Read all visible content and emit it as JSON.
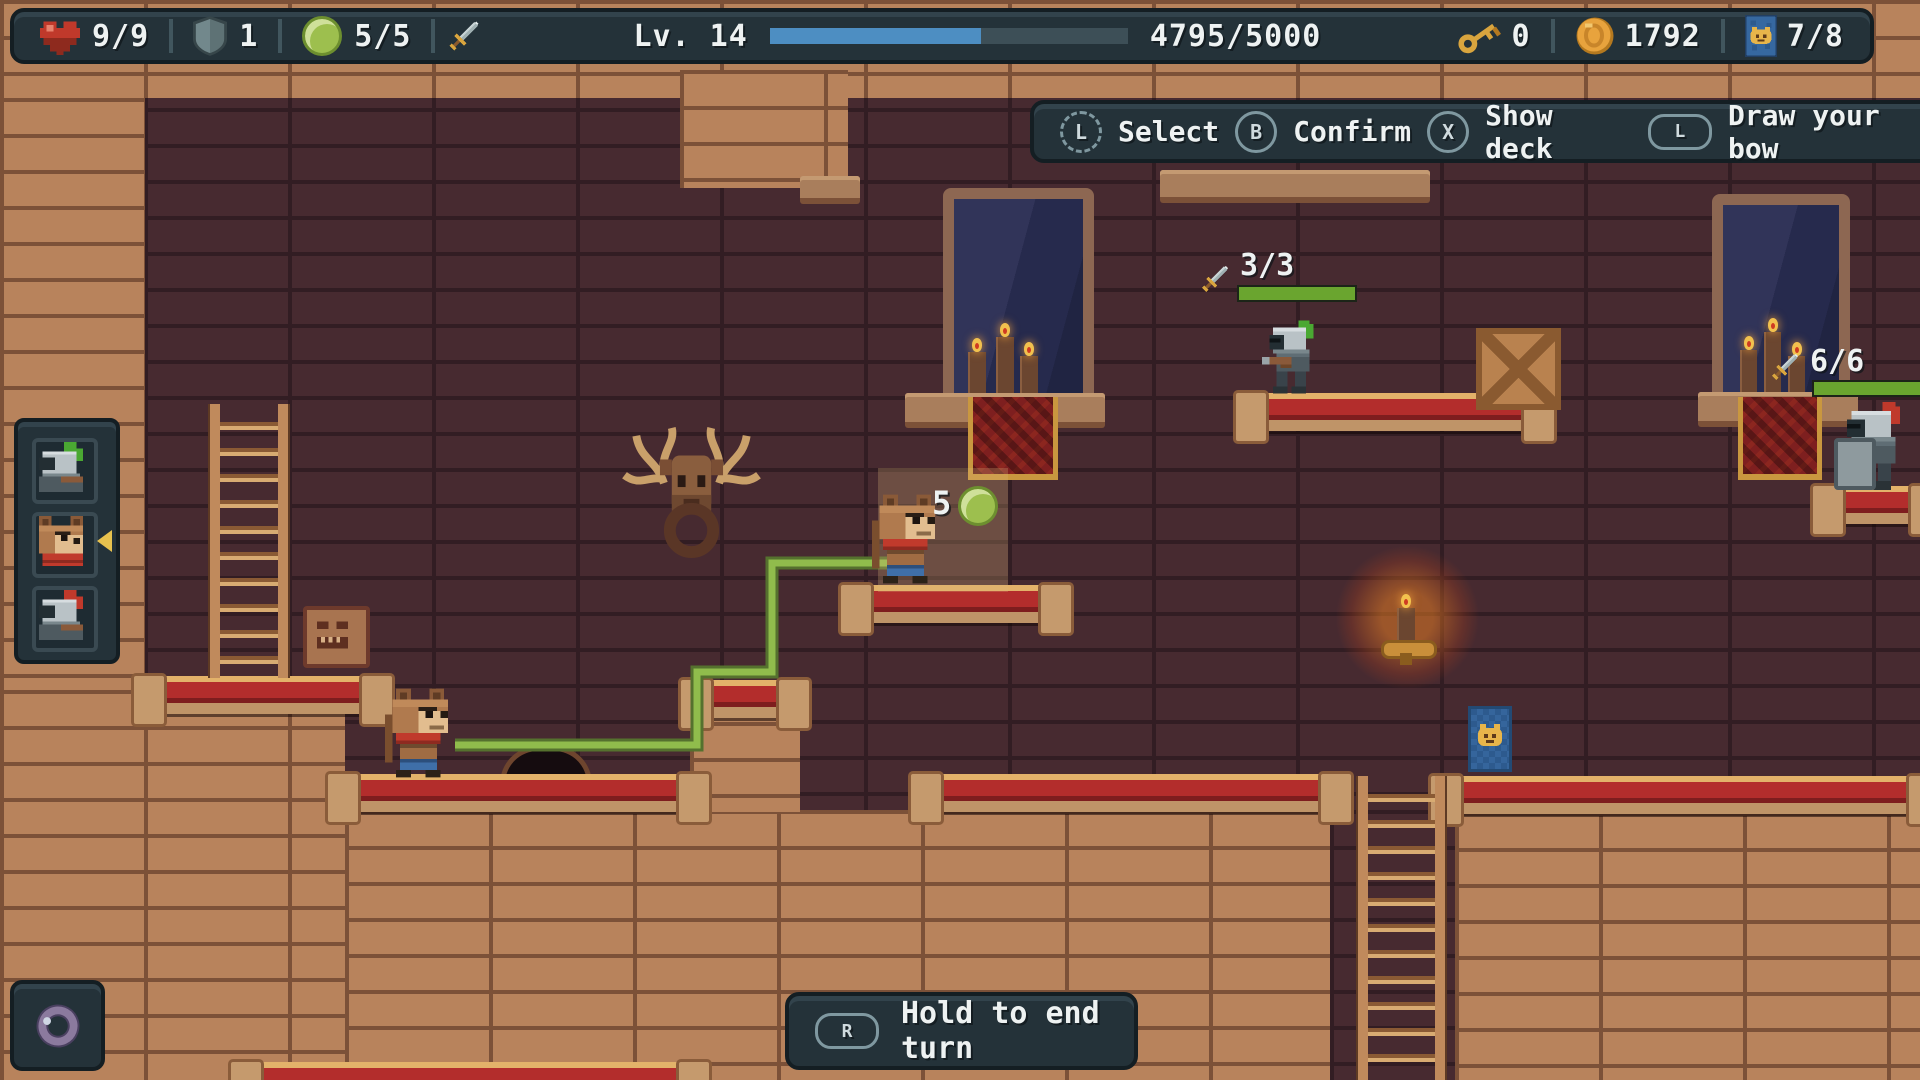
{
  "hud": {
    "hp": "9/9",
    "armor": "1",
    "energy": "5/5",
    "level_label": "Lv. 14",
    "xp_text": "4795/5000",
    "xp_fill_pct": 59,
    "keys": "0",
    "coins": "1792",
    "deck_count": "7/8"
  },
  "prompt_bar": {
    "items": [
      {
        "button": "L",
        "style": "stick",
        "label": "Select"
      },
      {
        "button": "B",
        "style": "face",
        "label": "Confirm"
      },
      {
        "button": "X",
        "style": "face",
        "label": "Show deck"
      },
      {
        "button": "L",
        "style": "shoulder",
        "label": "Draw your bow"
      }
    ]
  },
  "end_turn": {
    "button": "R",
    "label": "Hold to end turn"
  },
  "turn_order": {
    "units": [
      {
        "name": "knight-green-plume",
        "active": false
      },
      {
        "name": "bear-hero",
        "active": true
      },
      {
        "name": "knight-red-plume",
        "active": false
      }
    ]
  },
  "world": {
    "move_cost": "5",
    "enemies": [
      {
        "name": "knight-green-plume",
        "hp": "3/3",
        "hp_pct": 100
      },
      {
        "name": "knight-armored",
        "hp": "6/6",
        "hp_pct": 100
      }
    ]
  },
  "equipment": {
    "slot1": "ring"
  },
  "colors": {
    "xp_fill": "#4d8ec2",
    "hp_fill": "#6aa52f",
    "path_green": "#90bc4c",
    "carpet_red": "#b32d2c",
    "trim_gold": "#dca55c",
    "hud_bg": "#243239"
  }
}
